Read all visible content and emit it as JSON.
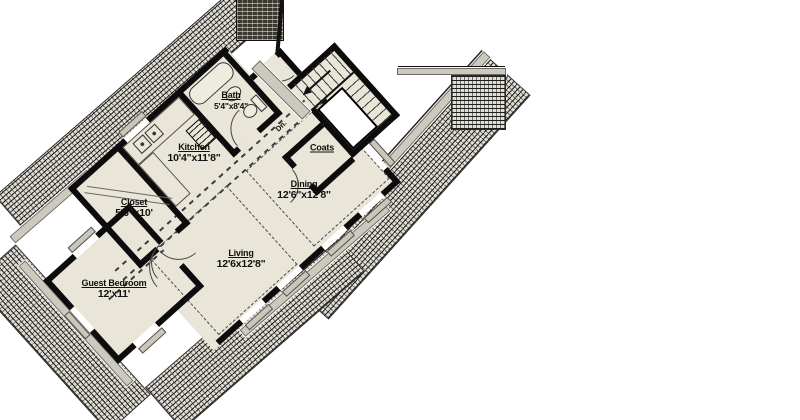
{
  "title": "Rotated hillside floor plan",
  "colors": {
    "floor": "#e9e5d8",
    "wall": "#0c0c0c",
    "sill_gray": "#c9c6bb",
    "hatch_base": "#e0ddd3"
  },
  "rooms": {
    "guest_bedroom": {
      "name": "Guest Bedroom",
      "dims": "12'x11'"
    },
    "closet": {
      "name": "Closet",
      "dims": "5'6\"x10'"
    },
    "kitchen": {
      "name": "Kitchen",
      "dims": "10'4\"x11'8\""
    },
    "bath": {
      "name": "Bath",
      "dims": "5'4\"x8'4\""
    },
    "coats": {
      "name": "Coats"
    },
    "dining": {
      "name": "Dining",
      "dims": "12'6\"x12'8\""
    },
    "living": {
      "name": "Living",
      "dims": "12'6x12'8\""
    }
  },
  "stairs": {
    "dn": "Dn."
  },
  "icons": {
    "hatch_bands": "stone-retaining-wall-hatch",
    "chimney": "masonry-chimney",
    "fixtures": [
      "bathtub",
      "bath-sink",
      "toilet",
      "kitchen-sink-basins",
      "pantry-shelves"
    ]
  }
}
